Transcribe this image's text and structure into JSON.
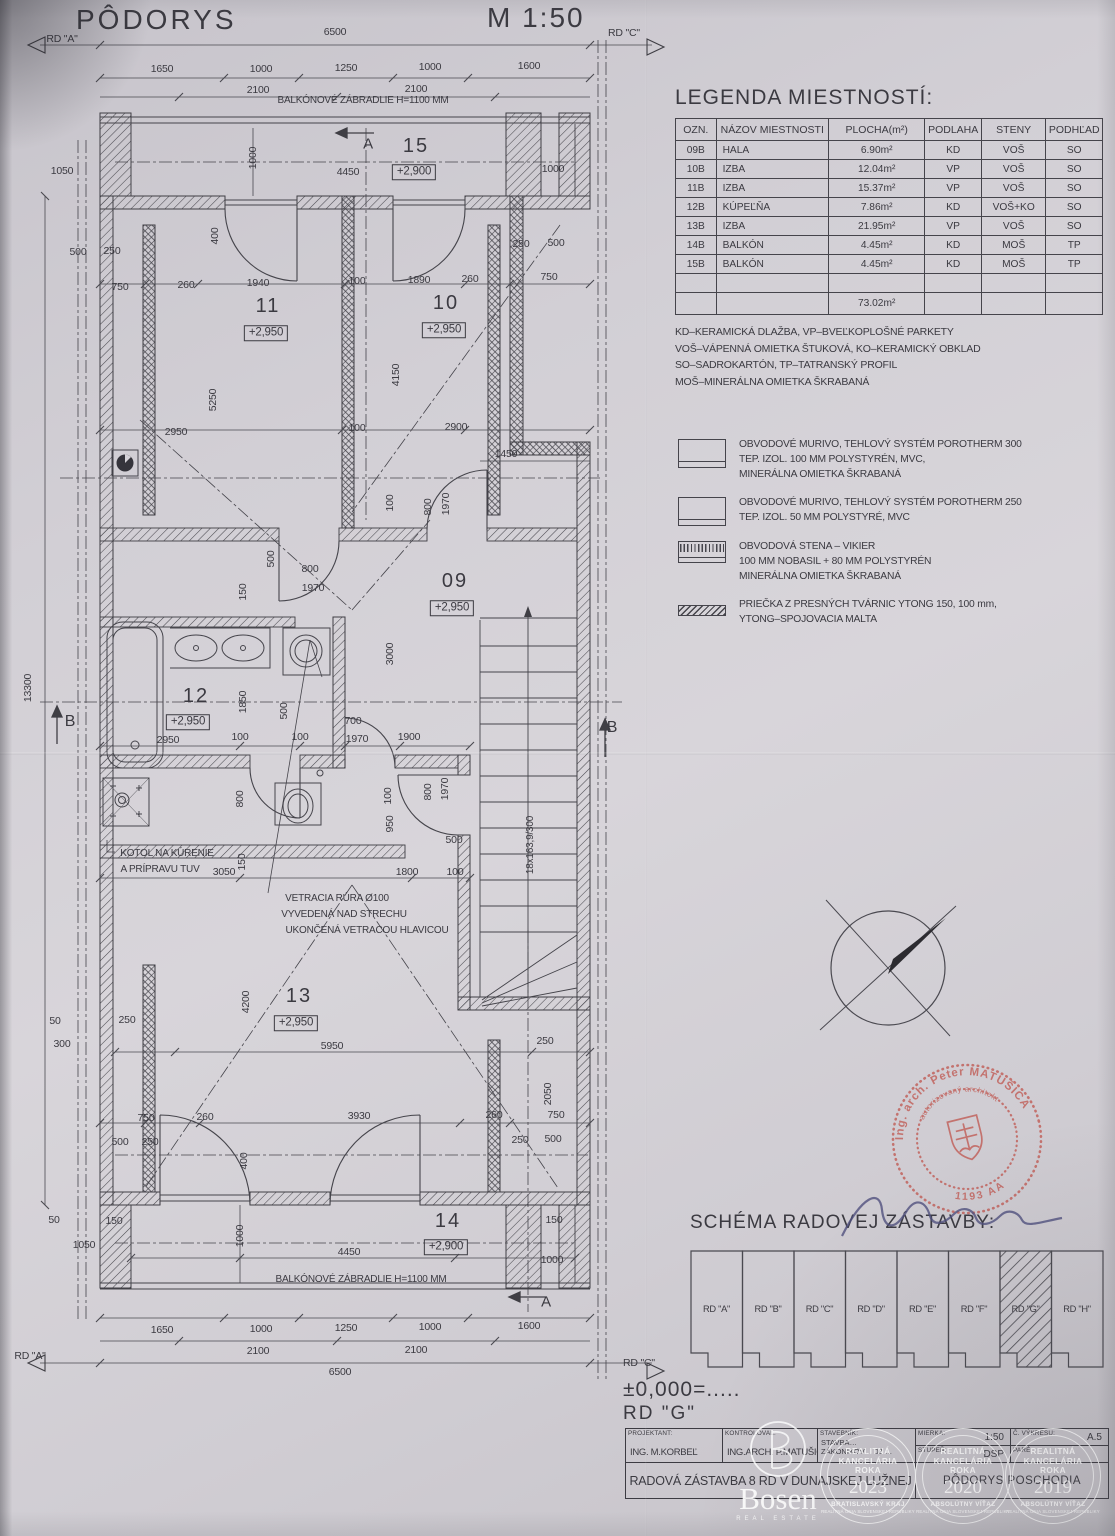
{
  "header": {
    "title": "PÔDORYS",
    "scale": "M 1:50"
  },
  "legend": {
    "title": "LEGENDA MIESTNOSTÍ:",
    "columns": [
      "OZN.",
      "NÁZOV MIESTNOSTI",
      "PLOCHA(m²)",
      "PODLAHA",
      "STENY",
      "PODHĽAD"
    ],
    "rows": [
      [
        "09B",
        "HALA",
        "6.90m²",
        "KD",
        "VOŠ",
        "SO"
      ],
      [
        "10B",
        "IZBA",
        "12.04m²",
        "VP",
        "VOŠ",
        "SO"
      ],
      [
        "11B",
        "IZBA",
        "15.37m²",
        "VP",
        "VOŠ",
        "SO"
      ],
      [
        "12B",
        "KÚPEĽŇA",
        "7.86m²",
        "KD",
        "VOŠ+KO",
        "SO"
      ],
      [
        "13B",
        "IZBA",
        "21.95m²",
        "VP",
        "VOŠ",
        "SO"
      ],
      [
        "14B",
        "BALKÓN",
        "4.45m²",
        "KD",
        "MOŠ",
        "TP"
      ],
      [
        "15B",
        "BALKÓN",
        "4.45m²",
        "KD",
        "MOŠ",
        "TP"
      ]
    ],
    "total": "73.02m²",
    "notes": [
      "KD–KERAMICKÁ DLAŽBA, VP–BVEĽKOPLOŠNÉ PARKETY",
      "VOŠ–VÁPENNÁ OMIETKA ŠTUKOVÁ, KO–KERAMICKÝ OBKLAD",
      "SO–SADROKARTÓN, TP–TATRANSKÝ PROFIL",
      "MOŠ–MINERÁLNA OMIETKA ŠKRABANÁ"
    ]
  },
  "materials": [
    {
      "icon": "wall-porotherm-300",
      "lines": [
        "OBVODOVÉ MURIVO, TEHLOVÝ SYSTÉM POROTHERM 300",
        "TEP. IZOL. 100 MM POLYSTYRÉN, MVC,",
        "MINERÁLNA OMIETKA ŠKRABANÁ"
      ]
    },
    {
      "icon": "wall-porotherm-250",
      "lines": [
        "OBVODOVÉ MURIVO, TEHLOVÝ SYSTÉM POROTHERM 250",
        "TEP. IZOL. 50 MM POLYSTYRÉ, MVC"
      ]
    },
    {
      "icon": "wall-vikier",
      "lines": [
        "OBVODOVÁ STENA – VIKIER",
        "100 MM NOBASIL + 80 MM POLYSTYRÉN",
        "MINERÁLNA OMIETKA ŠKRABANÁ"
      ]
    },
    {
      "icon": "wall-ytong",
      "lines": [
        "PRIEČKA Z PRESNÝCH TVÁRNIC YTONG 150, 100 mm,",
        "YTONG–SPOJOVACIA MALTA"
      ]
    }
  ],
  "schema": {
    "title": "SCHÉMA RADOVEJ ZÁSTAVBY:",
    "units": [
      "RD \"A\"",
      "RD \"B\"",
      "RD \"C\"",
      "RD \"D\"",
      "RD \"E\"",
      "RD \"F\"",
      "RD \"G\"",
      "RD \"H\""
    ],
    "highlighted": "RD \"G\""
  },
  "stamp": {
    "arc_top": "Ing. arch. Peter MATUŠICA",
    "arc_inner": "autorizovaný architekt",
    "number": "1193 AA"
  },
  "level_note": {
    "line1": "±0,000=.....",
    "line2": "RD  \"G\""
  },
  "titleblock": {
    "projektant_label": "PROJEKTANT:",
    "projektant": "ING.  M.KORBEĽ",
    "kontroloval_label": "KONTROLOVAL:",
    "kontroloval": "ING.ARCH.  P.MATUŠICA",
    "stavebnik_label": "STAVEBNÍK:",
    "stavebnik_line1": "STAVBA…",
    "stavebnik_line2": "ZÁKONIKOV… 03 …",
    "mierka_label": "MIERKA:",
    "mierka": "1:50",
    "stupen_label": "STUPEŇ:",
    "stupen": "DSP",
    "vykres_label": "Č. VÝKRESU:",
    "vykres": "A.5",
    "pare_label": "PARÉ:",
    "pare": "",
    "project_title": "RADOVÁ ZÁSTAVBA 8 RD V DUNAJSKEJ LUŽNEJ",
    "drawing_title": "PÔDORYS POSCHODIA"
  },
  "watermarks": {
    "bosen_word": "Bosen",
    "bosen_sub": "REAL ESTATE",
    "badges": [
      {
        "lines": [
          "REALITNÁ",
          "KANCELÁRIA",
          "ROKA"
        ],
        "year": "2023",
        "sub": "BRATISLAVSKÝ KRAJ",
        "sub2": "REALITNÁ ÚNIA SLOVENSKEJ REPUBLIKY"
      },
      {
        "lines": [
          "REALITNÁ",
          "KANCELÁRIA",
          "ROKA"
        ],
        "year": "2020",
        "sub": "ABSOLÚTNY VÍŤAZ",
        "sub2": "REALITNÁ ÚNIA SLOVENSKEJ REPUBLIKY"
      },
      {
        "lines": [
          "REALITNÁ",
          "KANCELÁRIA",
          "ROKA"
        ],
        "year": "2019",
        "sub": "ABSOLÚTNY VÍŤAZ",
        "sub2": "REALITNÁ ÚNIA SLOVENSKEJ REPUBLIKY"
      }
    ]
  },
  "plan": {
    "labels": [
      [
        "RD \"A\"",
        62,
        39
      ],
      [
        "6500",
        335,
        32
      ],
      [
        "RD \"C\"",
        624,
        33
      ],
      [
        "1650",
        162,
        69
      ],
      [
        "1000",
        261,
        69
      ],
      [
        "1250",
        346,
        68
      ],
      [
        "1000",
        430,
        67
      ],
      [
        "1600",
        529,
        66
      ],
      [
        "2100",
        258,
        90
      ],
      [
        "2100",
        416,
        89
      ],
      [
        "BALKÓNOVÉ ZÁBRADLIE H=1100 MM",
        363,
        101,
        "s10"
      ],
      [
        "A",
        368,
        144,
        "s15"
      ],
      [
        "15",
        416,
        146,
        "n"
      ],
      [
        "+2,900",
        414,
        172,
        "b"
      ],
      [
        "4450",
        348,
        172
      ],
      [
        "1050",
        62,
        171
      ],
      [
        "1000",
        253,
        158,
        "r"
      ],
      [
        "1000",
        553,
        169
      ],
      [
        "500",
        78,
        252
      ],
      [
        "250",
        112,
        251
      ],
      [
        "250",
        521,
        244
      ],
      [
        "500",
        556,
        243
      ],
      [
        "400",
        215,
        236,
        "r"
      ],
      [
        "750",
        120,
        287
      ],
      [
        "260",
        186,
        285
      ],
      [
        "1940",
        258,
        283
      ],
      [
        "100",
        357,
        281
      ],
      [
        "1890",
        419,
        280
      ],
      [
        "260",
        470,
        279
      ],
      [
        "750",
        549,
        277
      ],
      [
        "11",
        268,
        306,
        "n"
      ],
      [
        "+2,950",
        266,
        333,
        "b"
      ],
      [
        "10",
        446,
        303,
        "n"
      ],
      [
        "+2,950",
        444,
        330,
        "b"
      ],
      [
        "4150",
        396,
        375,
        "r"
      ],
      [
        "5250",
        213,
        400,
        "r"
      ],
      [
        "2950",
        176,
        432
      ],
      [
        "100",
        357,
        428
      ],
      [
        "2900",
        456,
        427
      ],
      [
        "1450",
        506,
        454
      ],
      [
        "100",
        390,
        503,
        "r"
      ],
      [
        "800",
        428,
        507,
        "r"
      ],
      [
        "1970",
        446,
        504,
        "r"
      ],
      [
        "500",
        271,
        559,
        "r"
      ],
      [
        "150",
        243,
        592,
        "r"
      ],
      [
        "800",
        310,
        569
      ],
      [
        "1970",
        313,
        588
      ],
      [
        "09",
        455,
        581,
        "n"
      ],
      [
        "+2,950",
        452,
        608,
        "b"
      ],
      [
        "3000",
        390,
        654,
        "r"
      ],
      [
        "12",
        196,
        696,
        "n"
      ],
      [
        "+2,950",
        188,
        722,
        "b"
      ],
      [
        "1850",
        243,
        702,
        "r"
      ],
      [
        "2950",
        168,
        740
      ],
      [
        "100",
        240,
        737
      ],
      [
        "100",
        300,
        737
      ],
      [
        "700",
        353,
        721
      ],
      [
        "1970",
        357,
        739
      ],
      [
        "1900",
        409,
        737
      ],
      [
        "500",
        284,
        711,
        "r"
      ],
      [
        "B",
        70,
        722,
        "s16"
      ],
      [
        "B",
        612,
        728,
        "s16"
      ],
      [
        "13300",
        28,
        688,
        "r"
      ],
      [
        "800",
        240,
        799,
        "r"
      ],
      [
        "100",
        388,
        796,
        "r"
      ],
      [
        "950",
        390,
        824,
        "r"
      ],
      [
        "800",
        428,
        792,
        "r"
      ],
      [
        "1970",
        445,
        789,
        "r"
      ],
      [
        "500",
        454,
        840
      ],
      [
        "1800",
        407,
        872
      ],
      [
        "100",
        455,
        872
      ],
      [
        "KOTOL NA KÚRENIE",
        167,
        854,
        "s10"
      ],
      [
        "A PRÍPRAVU TUV",
        160,
        870,
        "s10"
      ],
      [
        "3050",
        224,
        872
      ],
      [
        "150",
        242,
        862,
        "r"
      ],
      [
        "18x163,9/300",
        531,
        845,
        "r s10"
      ],
      [
        "VETRACIA RÚRA Ø100",
        337,
        899,
        "s10"
      ],
      [
        "VYVEDENÁ NAD STRECHU",
        344,
        915,
        "s10"
      ],
      [
        "UKONČENÁ VETRACOU HLAVICOU",
        367,
        931,
        "s10"
      ],
      [
        "50",
        55,
        1021
      ],
      [
        "250",
        127,
        1020
      ],
      [
        "300",
        62,
        1044
      ],
      [
        "13",
        299,
        996,
        "n"
      ],
      [
        "+2,950",
        296,
        1023,
        "b"
      ],
      [
        "4200",
        246,
        1002,
        "r"
      ],
      [
        "5950",
        332,
        1046
      ],
      [
        "250",
        545,
        1041
      ],
      [
        "2050",
        548,
        1094,
        "r"
      ],
      [
        "750",
        146,
        1118
      ],
      [
        "260",
        205,
        1117
      ],
      [
        "3930",
        359,
        1116
      ],
      [
        "260",
        494,
        1115
      ],
      [
        "750",
        556,
        1115
      ],
      [
        "500",
        120,
        1142
      ],
      [
        "250",
        150,
        1142
      ],
      [
        "250",
        520,
        1140
      ],
      [
        "500",
        553,
        1139
      ],
      [
        "400",
        244,
        1161,
        "r"
      ],
      [
        "14",
        448,
        1221,
        "n"
      ],
      [
        "+2,900",
        446,
        1247,
        "b"
      ],
      [
        "4450",
        349,
        1252
      ],
      [
        "1000",
        240,
        1236,
        "r"
      ],
      [
        "50",
        54,
        1220
      ],
      [
        "150",
        114,
        1221
      ],
      [
        "1050",
        84,
        1245
      ],
      [
        "150",
        554,
        1220
      ],
      [
        "1000",
        552,
        1260
      ],
      [
        "BALKÓNOVÉ ZÁBRADLIE H=1100 MM",
        361,
        1280,
        "s10"
      ],
      [
        "A",
        546,
        1302,
        "s15"
      ],
      [
        "1650",
        162,
        1330
      ],
      [
        "1000",
        261,
        1329
      ],
      [
        "1250",
        346,
        1328
      ],
      [
        "1000",
        430,
        1327
      ],
      [
        "1600",
        529,
        1326
      ],
      [
        "2100",
        258,
        1351
      ],
      [
        "2100",
        416,
        1350
      ],
      [
        "6500",
        340,
        1372
      ],
      [
        "RD \"A\"",
        30,
        1356
      ],
      [
        "RD \"C\"",
        639,
        1363
      ]
    ]
  }
}
